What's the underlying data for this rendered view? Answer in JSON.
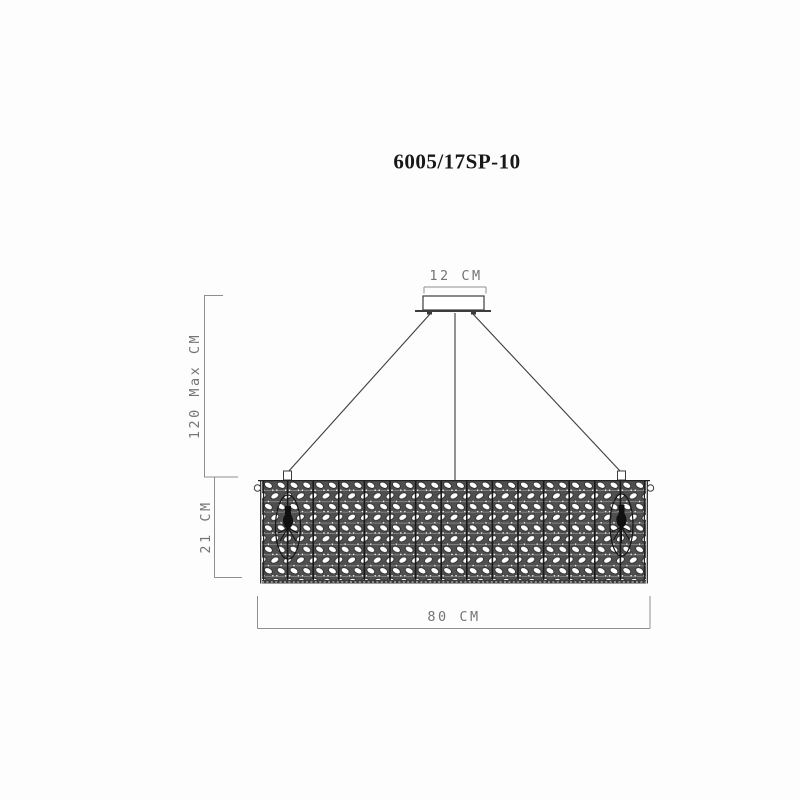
{
  "title": "6005/17SP-10",
  "dimensions": {
    "canopy_width": "12 CM",
    "drop_height": "120 Max CM",
    "shade_height": "21 CM",
    "shade_width": "80 CM"
  },
  "colors": {
    "background": "#fdfdfd",
    "drawing_line": "#3c3c3c",
    "dimension_line": "#8f8f8f",
    "dimension_text": "#757575",
    "pattern_dark": "#4f4f4f",
    "pattern_light": "#ffffff",
    "title_text": "#181818"
  }
}
